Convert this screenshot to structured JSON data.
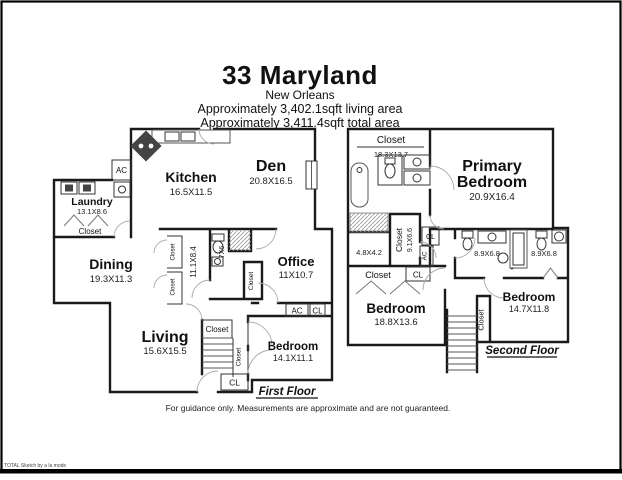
{
  "header": {
    "title": "33 Maryland",
    "subtitle": "New Orleans",
    "living_area": "Approximately 3,402.1sqft living area",
    "total_area": "Approximately 3,411.4sqft total area"
  },
  "labels": {
    "closet": "Closet",
    "cl": "CL",
    "ac": "AC"
  },
  "first_floor": {
    "caption": "First Floor",
    "rooms": {
      "laundry": {
        "name": "Laundry",
        "dims": "13.1X8.6"
      },
      "kitchen": {
        "name": "Kitchen",
        "dims": "16.5X11.5"
      },
      "den": {
        "name": "Den",
        "dims": "20.8X16.5"
      },
      "dining": {
        "name": "Dining",
        "dims": "19.3X11.3"
      },
      "office": {
        "name": "Office",
        "dims": "11X10.7"
      },
      "living": {
        "name": "Living",
        "dims": "15.6X15.5"
      },
      "bedroom": {
        "name": "Bedroom",
        "dims": "14.1X11.1"
      },
      "hall_dims": "11.1X8.4",
      "bath_dims": "7X6"
    }
  },
  "second_floor": {
    "caption": "Second Floor",
    "rooms": {
      "primary": {
        "name_line1": "Primary",
        "name_line2": "Bedroom",
        "dims": "20.9X16.4"
      },
      "closet_suite": {
        "dims": "18.3X13.7"
      },
      "walk_in_closet": {
        "name": "Closet",
        "dims": "9.1X6.6"
      },
      "small_room": {
        "dims": "4.8X4.2"
      },
      "bedroom_left": {
        "name": "Bedroom",
        "dims": "18.8X13.6"
      },
      "bedroom_right": {
        "name": "Bedroom",
        "dims": "14.7X11.8"
      },
      "bath_left_dims": "8.9X6.8",
      "bath_right_dims": "8.9X6.8"
    }
  },
  "footer": {
    "disclaimer": "For guidance only. Measurements are approximate and are not guaranteed.",
    "watermark": "TOTAL Sketch by a la mode"
  }
}
